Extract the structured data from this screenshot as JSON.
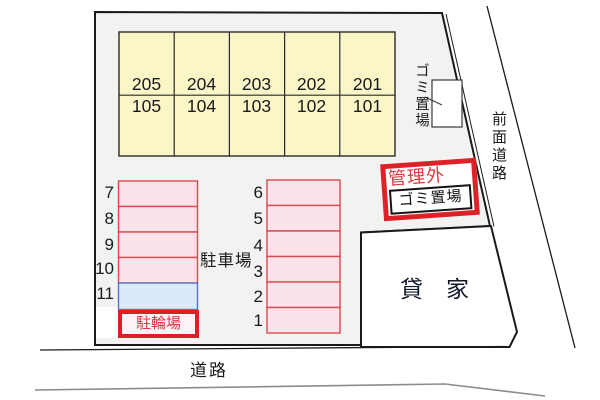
{
  "colors": {
    "property_fill": "#F2F2F0",
    "building_fill": "#FAF6C8",
    "parking_spot_fill": "#FBE3E9",
    "parking_spot_border": "#D94A52",
    "bike_spot_fill": "#D9EBFA",
    "bike_spot_border": "#5B6FD0",
    "alert_red": "#DE2126",
    "outline_black": "#1A1A1A",
    "road_gray": "#8C8C8C"
  },
  "building": {
    "upper_rooms": [
      "205",
      "204",
      "203",
      "202",
      "201"
    ],
    "lower_rooms": [
      "105",
      "104",
      "103",
      "102",
      "101"
    ]
  },
  "parking": {
    "area_label": "駐車場",
    "left_spots": [
      "7",
      "8",
      "9",
      "10",
      "11"
    ],
    "right_spots": [
      "6",
      "5",
      "4",
      "3",
      "2",
      "1"
    ]
  },
  "labels": {
    "bicycle_parking": "駐輪場",
    "garbage_area_top": "ゴミ置場",
    "unmanaged_title": "管理外",
    "unmanaged_garbage": "ゴミ置場",
    "rental_house": "貸　家",
    "front_road": "前面道路",
    "bottom_road": "道路"
  }
}
